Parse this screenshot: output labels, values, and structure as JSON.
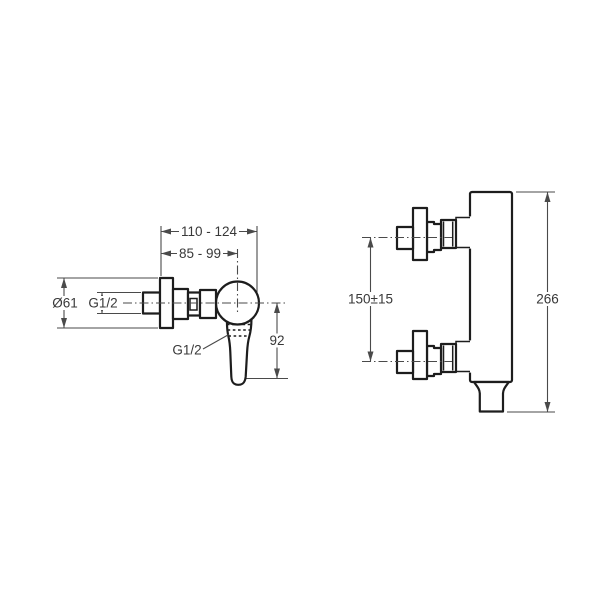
{
  "drawing": {
    "type": "shower-mixer-technical-dimension-drawing",
    "colors": {
      "object_line": "#1d1d1d",
      "dimension_line": "#4a4a4a",
      "text": "#383838",
      "background": "#ffffff"
    },
    "front_view": {
      "width_range_outer": "110 - 124",
      "width_range_inner": "85 - 99",
      "escutcheon_diameter": "Ø61",
      "inlet_thread": "G1/2",
      "outlet_thread": "G1/2",
      "handle_drop": "92"
    },
    "side_view": {
      "inlet_spacing": "150±15",
      "overall_height": "266"
    }
  }
}
